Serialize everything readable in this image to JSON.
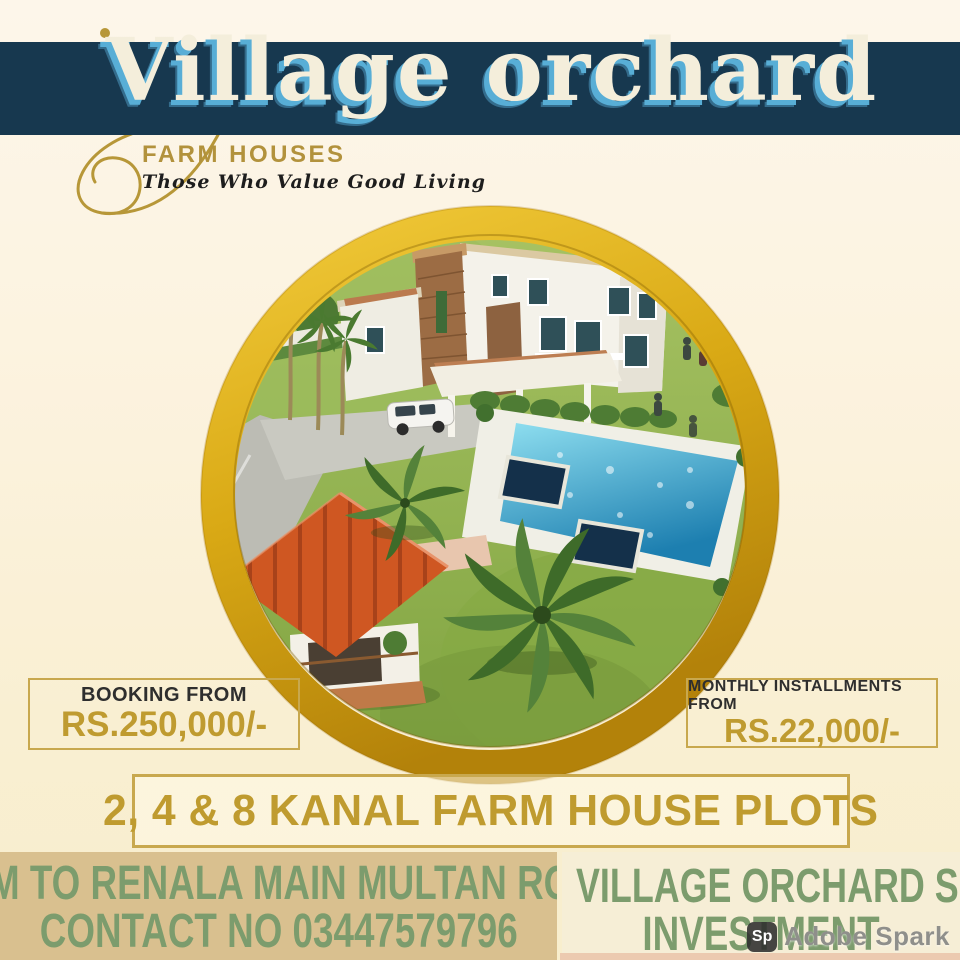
{
  "poster": {
    "title": "Village orchard",
    "logo": {
      "name": "FARM HOUSES",
      "tagline": "Those Who Value Good Living"
    },
    "pricing": {
      "booking_label": "BOOKING FROM",
      "booking_amount": "RS.250,000/-",
      "installment_label": "MONTHLY INSTALLMENTS FROM",
      "installment_amount": "RS.22,000/-"
    },
    "plots_banner": "2, 4 & 8 KANAL FARM HOUSE PLOTS",
    "footer": {
      "left_line1": "6 KM TO RENALA MAIN MULTAN ROAD",
      "left_line2": "CONTACT NO 03447579796",
      "right_line1": "VILLAGE ORCHARD SUPREME",
      "right_line2": "INVESTMENT"
    },
    "watermark": {
      "badge": "Sp",
      "label": "Adobe Spark"
    },
    "hero_image": {
      "description": "aerial 3D render: white farm house, stone tower, swimming pool, red-roof gazebo, palms, lawn, SUV"
    },
    "colors": {
      "banner_navy": "#17384f",
      "title_cream": "#f4eedb",
      "title_blue_shadow": "#58aed6",
      "gold_accent": "#bf9b30",
      "gold_ring": "#d9a915",
      "footer_green": "#7c9c6d",
      "footer_tan": "#d9c08f",
      "background_cream": "#fbf2dc"
    }
  }
}
